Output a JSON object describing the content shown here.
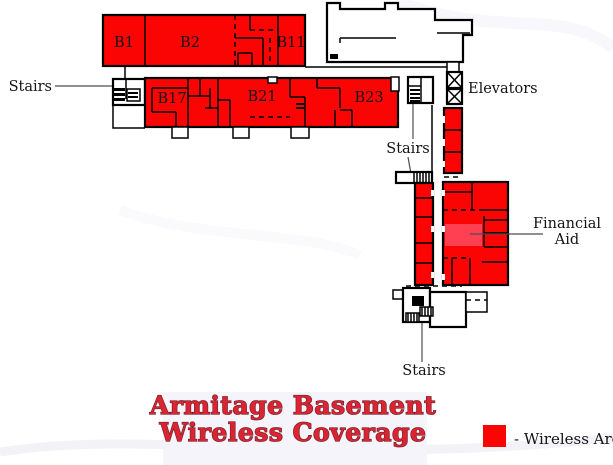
{
  "title": {
    "line1": "Armitage Basement",
    "line2": "Wireless Coverage",
    "color": "#da2431",
    "panel_color": "#f5f4fb"
  },
  "legend": {
    "label": "- Wireless Area"
  },
  "rooms": {
    "b1": "B1",
    "b2": "B2",
    "b11": "B11",
    "b17": "B17",
    "b21": "B21",
    "b23": "B23"
  },
  "annotations": {
    "stairs_top": "Stairs",
    "stairs_mid": "Stairs",
    "stairs_bottom": "Stairs",
    "elevators": "Elevators",
    "financial_line1": "Financial",
    "financial_line2": "Aid"
  },
  "colors": {
    "coverage": "#fb0404",
    "highlight": "#ff4053",
    "walls": "#000000",
    "leader": "#4d4d4d"
  }
}
